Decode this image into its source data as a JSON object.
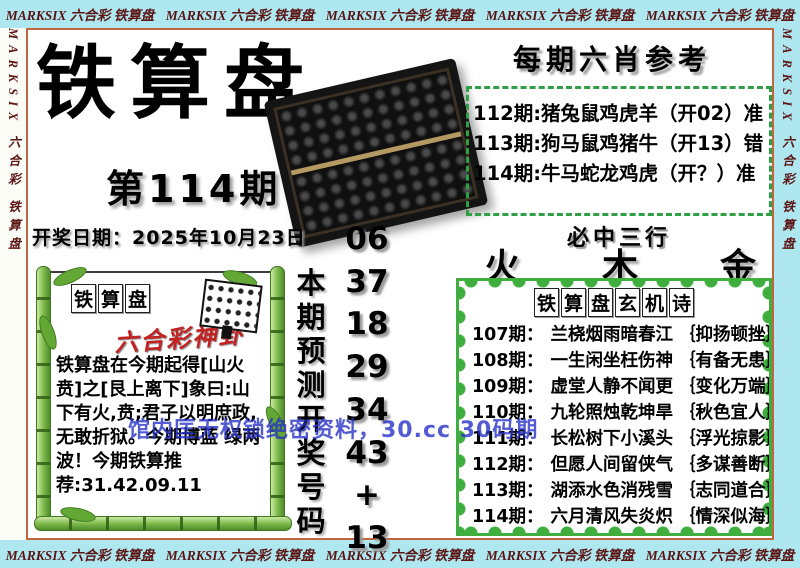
{
  "border": {
    "pattern": "MARKSIX 六合彩 铁算盘",
    "top_count": 5,
    "side_count": 3
  },
  "header": {
    "title": "铁算盘",
    "issue": "第114期",
    "draw_date": "开奖日期：2025年10月23日"
  },
  "six_xiao": {
    "title": "每期六肖参考",
    "rows": [
      "112期:猪兔鼠鸡虎羊（开02）准",
      "113期:狗马鼠鸡猪牛（开13）错",
      "114期:牛马蛇龙鸡虎（开？）准"
    ]
  },
  "three_rows": {
    "title": "必中三行",
    "values": [
      "火",
      "木",
      "金"
    ]
  },
  "poems": {
    "title": "铁算盘玄机诗",
    "rows": [
      {
        "period": "107期：",
        "poem": "兰桡烟雨暗春江",
        "note": "｛抑扬顿挫｝"
      },
      {
        "period": "108期：",
        "poem": "一生闲坐枉伤神",
        "note": "｛有备无患｝"
      },
      {
        "period": "109期：",
        "poem": "虚堂人静不闻更",
        "note": "｛变化万端｝"
      },
      {
        "period": "110期：",
        "poem": "九轮照烛乾坤旱",
        "note": "｛秋色宜人｝"
      },
      {
        "period": "111期：",
        "poem": "长松树下小溪头",
        "note": "｛浮光掠影｝"
      },
      {
        "period": "112期：",
        "poem": "但愿人间留侠气",
        "note": "｛多谋善断｝"
      },
      {
        "period": "113期：",
        "poem": "湖添水色消残雪",
        "note": "｛志同道合｝"
      },
      {
        "period": "114期：",
        "poem": "六月清风失炎炽",
        "note": "｛情深似海｝"
      }
    ]
  },
  "prediction": {
    "label": "本期预测开奖号码",
    "numbers": [
      "06",
      "37",
      "18",
      "29",
      "34",
      "43",
      "+",
      "13"
    ]
  },
  "oracle": {
    "title": "铁算盘",
    "subtitle": "六合彩神卦",
    "body": "铁算盘在今期起得[山火贲]之[艮上离下]象曰:山下有火,贲;君子以明庶政,无敢折狱。今期博蓝 绿两波！今期铁算推荐:31.42.09.11"
  },
  "watermark": {
    "text": "馆内匡无权锁绝密资料，30.cc 30码期"
  },
  "colors": {
    "border_strip": "#aee7ef",
    "border_text": "#5c1414",
    "frame": "#c2653f",
    "dashed_green": "#2f9e44",
    "scallop_green": "#3fae3f",
    "bamboo_green": "#7ab648",
    "red_accent": "#c32222",
    "watermark_blue": "#2832c8"
  }
}
